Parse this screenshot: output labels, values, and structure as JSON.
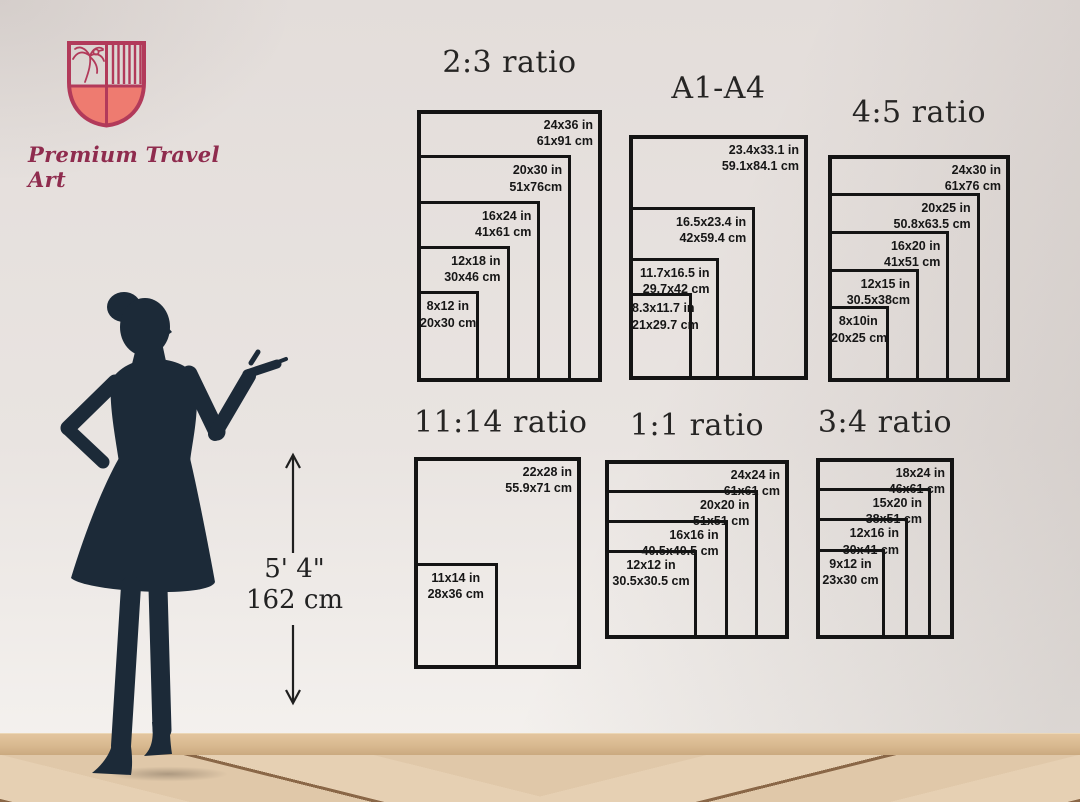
{
  "brand": {
    "name": "Premium Travel Art",
    "logo_icon": "shield-crest-icon",
    "colors": {
      "coral": "#ee7b70",
      "maroon": "#b23a5a",
      "text": "#8f2c4e"
    }
  },
  "reference_figure": {
    "description": "woman-silhouette",
    "height_imperial": "5' 4\"",
    "height_metric": "162 cm"
  },
  "colors": {
    "chart_line": "#141414",
    "silhouette": "#1c2a38",
    "wall": "#e9e4e1",
    "floor_plank": "#e4cdb0",
    "baseboard": "#d8b88f"
  },
  "chart_data": [
    {
      "type": "table",
      "title": "2:3 ratio",
      "layout": "nested-rectangles-bottom-left",
      "sizes": [
        {
          "w": 24,
          "h": 36,
          "in": "24x36 in",
          "cm": "61x91 cm"
        },
        {
          "w": 20,
          "h": 30,
          "in": "20x30 in",
          "cm": "51x76cm"
        },
        {
          "w": 16,
          "h": 24,
          "in": "16x24 in",
          "cm": "41x61 cm"
        },
        {
          "w": 12,
          "h": 18,
          "in": "12x18 in",
          "cm": "30x46 cm"
        },
        {
          "w": 8,
          "h": 12,
          "in": "8x12 in",
          "cm": "20x30 cm"
        }
      ]
    },
    {
      "type": "table",
      "title": "A1-A4",
      "layout": "nested-rectangles-bottom-left",
      "sizes": [
        {
          "w": 23.4,
          "h": 33.1,
          "in": "23.4x33.1 in",
          "cm": "59.1x84.1 cm"
        },
        {
          "w": 16.5,
          "h": 23.4,
          "in": "16.5x23.4 in",
          "cm": "42x59.4 cm"
        },
        {
          "w": 11.7,
          "h": 16.5,
          "in": "11.7x16.5 in",
          "cm": "29.7x42 cm"
        },
        {
          "w": 8.3,
          "h": 11.7,
          "in": "8.3x11.7 in",
          "cm": "21x29.7 cm"
        }
      ]
    },
    {
      "type": "table",
      "title": "4:5 ratio",
      "layout": "nested-rectangles-bottom-left",
      "sizes": [
        {
          "w": 24,
          "h": 30,
          "in": "24x30 in",
          "cm": "61x76 cm"
        },
        {
          "w": 20,
          "h": 25,
          "in": "20x25 in",
          "cm": "50.8x63.5 cm"
        },
        {
          "w": 16,
          "h": 20,
          "in": "16x20 in",
          "cm": "41x51 cm"
        },
        {
          "w": 12,
          "h": 15,
          "in": "12x15 in",
          "cm": "30.5x38cm"
        },
        {
          "w": 8,
          "h": 10,
          "in": "8x10in",
          "cm": "20x25 cm"
        }
      ]
    },
    {
      "type": "table",
      "title": "11:14 ratio",
      "layout": "nested-rectangles-bottom-left",
      "sizes": [
        {
          "w": 22,
          "h": 28,
          "in": "22x28 in",
          "cm": "55.9x71 cm"
        },
        {
          "w": 11,
          "h": 14,
          "in": "11x14 in",
          "cm": "28x36 cm"
        }
      ]
    },
    {
      "type": "table",
      "title": "1:1 ratio",
      "layout": "nested-rectangles-bottom-left",
      "sizes": [
        {
          "w": 24,
          "h": 24,
          "in": "24x24 in",
          "cm": "61x61 cm"
        },
        {
          "w": 20,
          "h": 20,
          "in": "20x20 in",
          "cm": "51x51 cm"
        },
        {
          "w": 16,
          "h": 16,
          "in": "16x16 in",
          "cm": "40.5x40.5 cm"
        },
        {
          "w": 12,
          "h": 12,
          "in": "12x12 in",
          "cm": "30.5x30.5 cm"
        }
      ]
    },
    {
      "type": "table",
      "title": "3:4 ratio",
      "layout": "nested-rectangles-bottom-left",
      "sizes": [
        {
          "w": 18,
          "h": 24,
          "in": "18x24 in",
          "cm": "46x61 cm"
        },
        {
          "w": 15,
          "h": 20,
          "in": "15x20 in",
          "cm": "38x51 cm"
        },
        {
          "w": 12,
          "h": 16,
          "in": "12x16 in",
          "cm": "30x41 cm"
        },
        {
          "w": 9,
          "h": 12,
          "in": "9x12 in",
          "cm": "23x30 cm"
        }
      ]
    }
  ]
}
